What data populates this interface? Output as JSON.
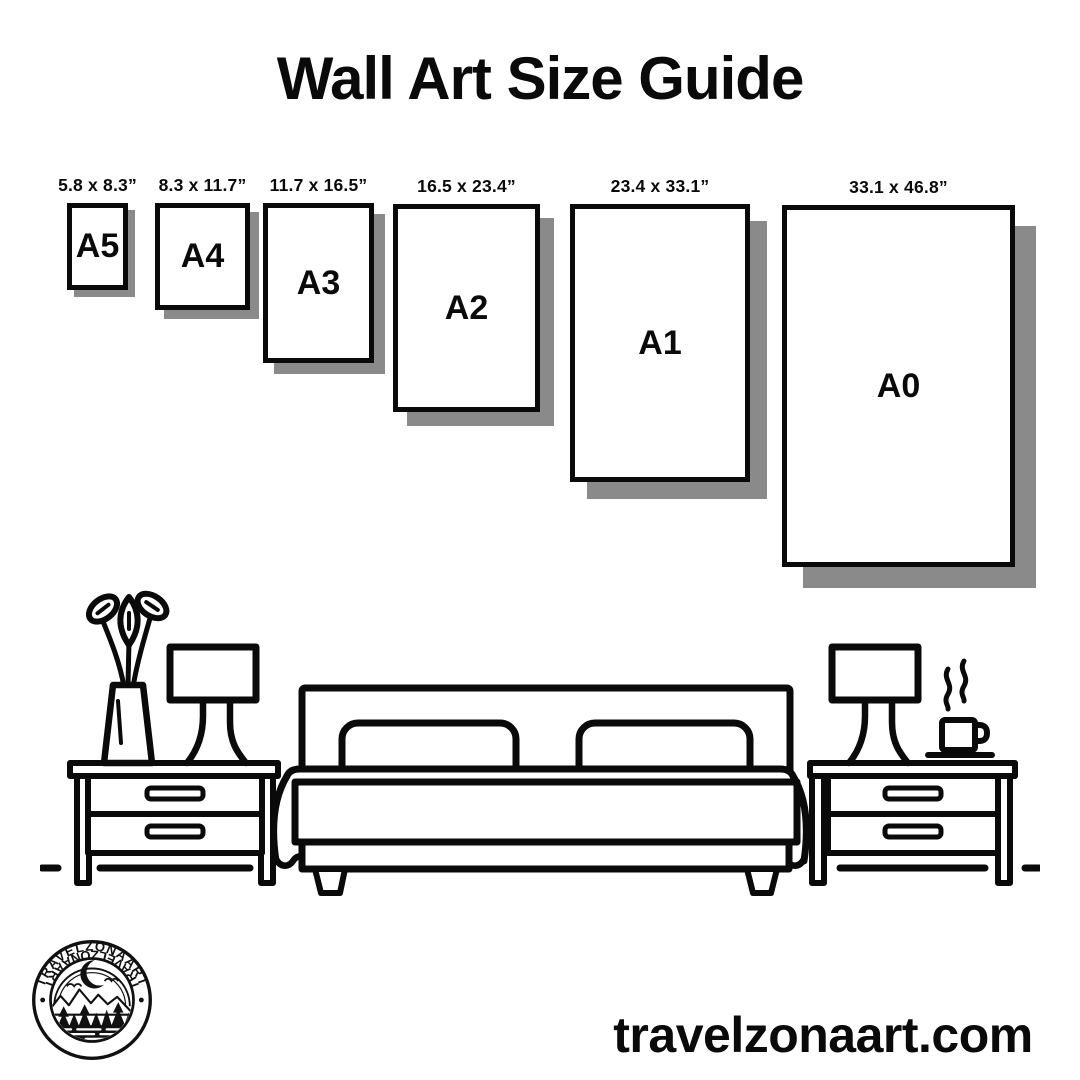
{
  "title": "Wall Art Size Guide",
  "sizes": [
    {
      "code": "A5",
      "dimensions": "5.8 x 8.3”",
      "box": {
        "x": 67,
        "y": 203,
        "w": 61,
        "h": 87,
        "sh": 7
      }
    },
    {
      "code": "A4",
      "dimensions": "8.3 x 11.7”",
      "box": {
        "x": 155,
        "y": 203,
        "w": 95,
        "h": 107,
        "sh": 9
      }
    },
    {
      "code": "A3",
      "dimensions": "11.7 x 16.5”",
      "box": {
        "x": 263,
        "y": 203,
        "w": 111,
        "h": 160,
        "sh": 11
      }
    },
    {
      "code": "A2",
      "dimensions": "16.5 x 23.4”",
      "box": {
        "x": 393,
        "y": 204,
        "w": 147,
        "h": 208,
        "sh": 14
      }
    },
    {
      "code": "A1",
      "dimensions": "23.4 x 33.1”",
      "box": {
        "x": 570,
        "y": 204,
        "w": 180,
        "h": 278,
        "sh": 17
      }
    },
    {
      "code": "A0",
      "dimensions": "33.1 x 46.8”",
      "box": {
        "x": 782,
        "y": 205,
        "w": 233,
        "h": 362,
        "sh": 21
      }
    }
  ],
  "logo": {
    "brand": "TRAVELZONAART"
  },
  "footer": {
    "website": "travelzonaart.com"
  },
  "icons": [
    "vase-flowers-icon",
    "table-lamp-icon",
    "nightstand-icon",
    "bed-icon",
    "coffee-cup-icon",
    "steam-icon",
    "floor-line-icon",
    "brand-logo"
  ],
  "colors": {
    "ink": "#0a0a0a",
    "shadow": "#8a8a8a",
    "background": "#ffffff"
  }
}
